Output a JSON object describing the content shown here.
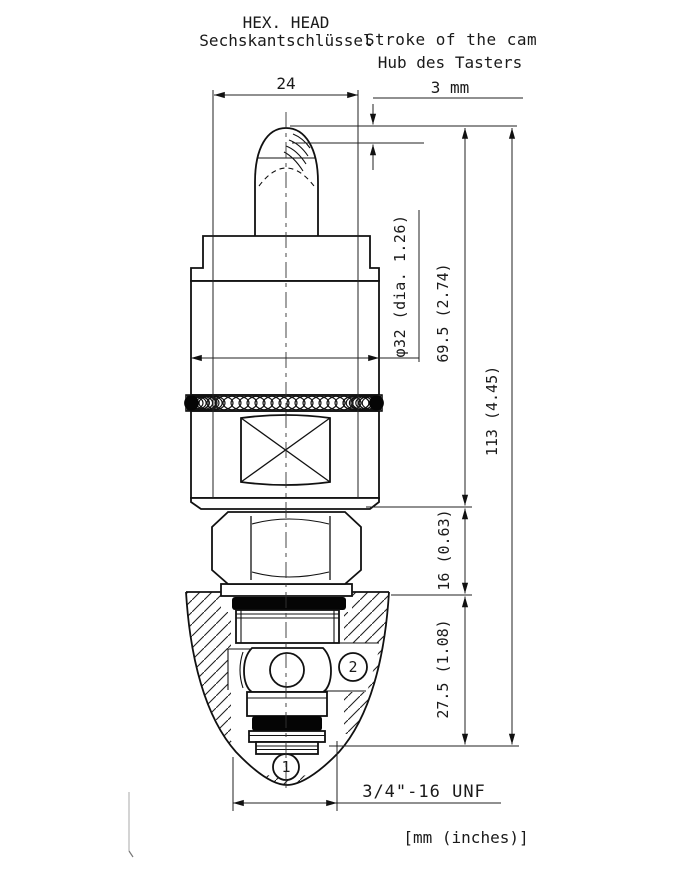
{
  "labels": {
    "hex_head_en": "HEX. HEAD",
    "hex_head_de": "Sechskantschlüssel",
    "stroke_en": "Stroke of the cam",
    "stroke_de": "Hub des Tasters",
    "stroke_value": "3 mm"
  },
  "dimensions": {
    "hex_width": "24",
    "body_diameter": "φ32 (dia. 1.26)",
    "upper_height": "69.5 (2.74)",
    "overall_height": "113 (4.45)",
    "hex_height": "16 (0.63)",
    "cartridge_depth": "27.5 (1.08)",
    "thread": "3/4\"-16 UNF",
    "units_note": "[mm (inches)]"
  },
  "ports": {
    "port_1": "1",
    "port_2": "2"
  },
  "colors": {
    "line": "#111111",
    "seal_fill": "#050505",
    "background": "#ffffff"
  }
}
